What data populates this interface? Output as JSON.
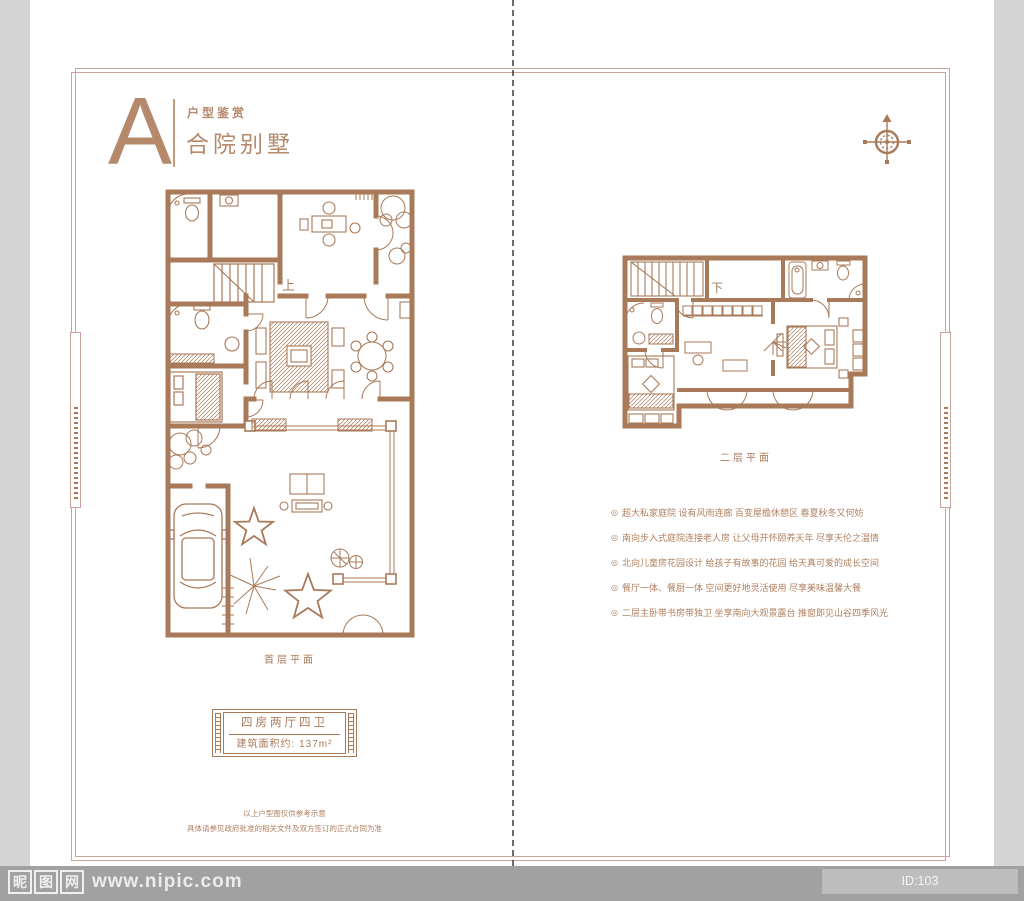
{
  "header": {
    "letter": "A",
    "small_title": "户型鉴赏",
    "main_title": "合院别墅"
  },
  "plans": {
    "first_label": "首层平面",
    "second_label": "二层平面",
    "stair_up": "上",
    "stair_down": "下"
  },
  "features": {
    "bullet": "◎",
    "items": [
      "超大私家庭院 设有风雨连廊 百变屋檐休憩区 春夏秋冬又何妨",
      "南向步入式庭院连接老人房 让父母开怀颐养天年 尽享天伦之温情",
      "北向儿童房花园设计 给孩子有故事的花园 给天真可爱的成长空间",
      "餐厅一体、餐厨一体 空间更好地灵活使用 尽享美味温馨大餐",
      "二层主卧带书房带独卫 坐享南向大观景露台 推窗即见山谷四季风光"
    ]
  },
  "spec": {
    "rooms": "四房两厅四卫",
    "area": "建筑面积约: 137m²"
  },
  "disclaimer": {
    "line1": "以上户型图仅供参考示意",
    "line2": "具体请参见政府批准的相关文件及双方签订的正式合同为准"
  },
  "watermark": {
    "logo_chars": [
      "昵",
      "图",
      "网"
    ],
    "site": "www.nipic.com",
    "id_label": "ID:103 NO:20200506165835175081"
  },
  "colors": {
    "accent": "#a87a5a",
    "frame": "#c9a29a",
    "canvas_bg": "#d4d4d4",
    "band_bg": "#a1a1a1"
  }
}
